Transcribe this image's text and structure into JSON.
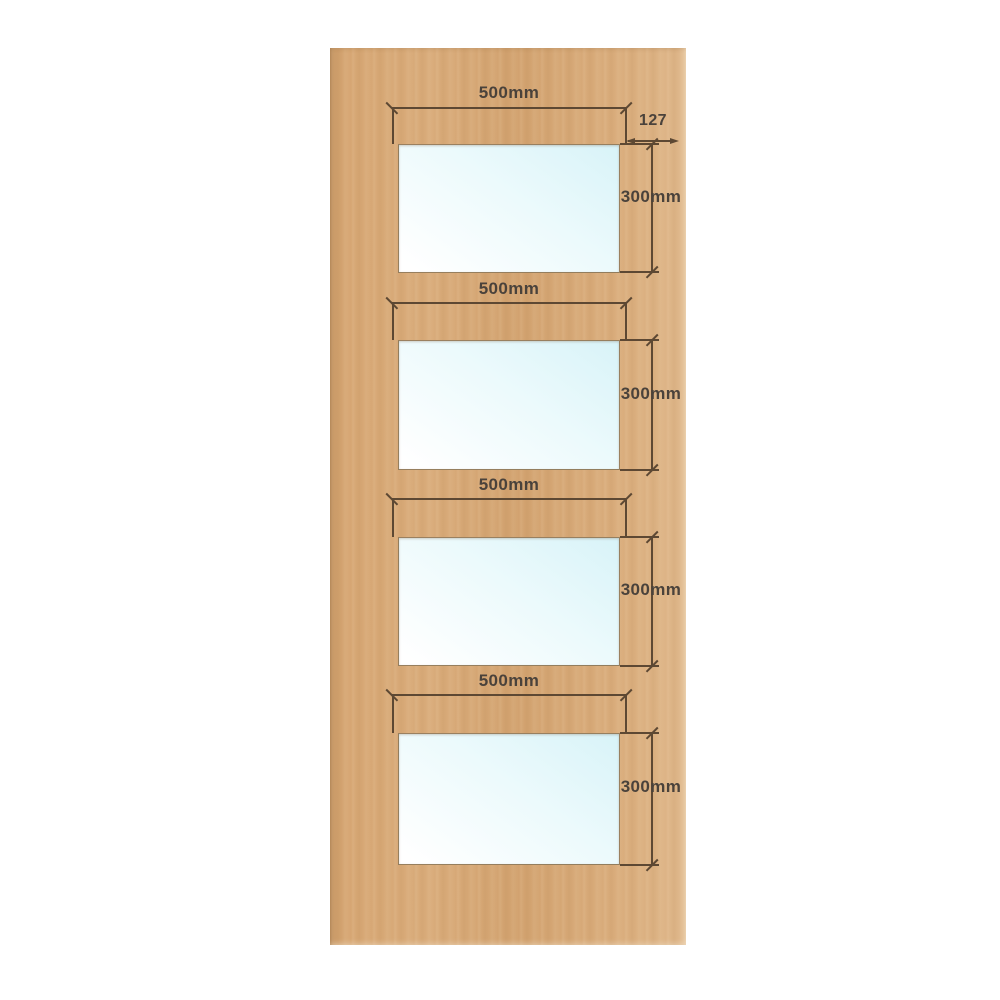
{
  "title": "Plywood door with four glazed panels - dimension diagram",
  "colors": {
    "background": "#ffffff",
    "wood": "#d6a673",
    "line": "#5d4833",
    "text": "#4a423b",
    "glass_tint": "#d8f3f8",
    "glass_white": "#ffffff"
  },
  "panels": [
    {
      "width_label": "500mm",
      "height_label": "300mm"
    },
    {
      "width_label": "500mm",
      "height_label": "300mm"
    },
    {
      "width_label": "500mm",
      "height_label": "300mm"
    },
    {
      "width_label": "500mm",
      "height_label": "300mm"
    }
  ],
  "edge_dimension": {
    "label": "127"
  }
}
